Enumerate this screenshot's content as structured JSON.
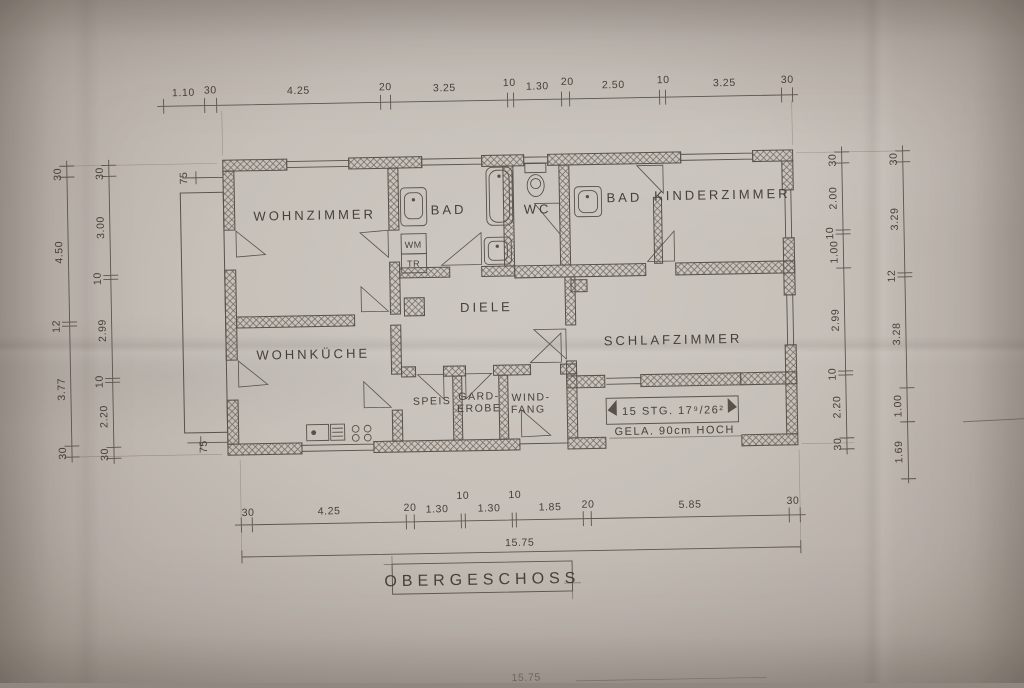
{
  "document": {
    "title": "OBERGESCHOSS",
    "type_note": "hand-drawn architectural floor plan photo"
  },
  "rooms": {
    "wohnzimmer": "WOHNZIMMER",
    "bad1": "BAD",
    "wc": "WC",
    "bad2": "BAD",
    "kinderzimmer": "KINDERZIMMER",
    "diele": "DIELE",
    "wohnkueche": "WOHNKÜCHE",
    "speis": "SPEIS",
    "garderobe_line1": "GARD-",
    "garderobe_line2": "EROBE",
    "windfang_line1": "WIND-",
    "windfang_line2": "FANG",
    "schlafzimmer": "SCHLAFZIMMER",
    "wm": "WM",
    "tr": "TR"
  },
  "stairs": {
    "label": "15 STG. 17⁹/26²",
    "railing_note": "GELA. 90cm HOCH"
  },
  "dims": {
    "top": [
      "1.10",
      "30",
      "4.25",
      "20",
      "3.25",
      "10",
      "1.30",
      "20",
      "2.50",
      "10",
      "3.25",
      "30"
    ],
    "bottom": [
      "30",
      "4.25",
      "20",
      "1.30",
      "10",
      "1.30",
      "10",
      "1.85",
      "20",
      "5.85",
      "30"
    ],
    "bottom_total": "15.75",
    "left_outer": [
      "30",
      "4.50",
      "12",
      "3.77",
      "30"
    ],
    "left_inner": [
      "30",
      "3.00",
      "10",
      "2.99",
      "10",
      "2.20",
      "30"
    ],
    "right_inner": [
      "30",
      "2.00",
      "10",
      "1.00",
      "2.99",
      "10",
      "2.20",
      "30"
    ],
    "right_outer": [
      "30",
      "3.29",
      "12",
      "3.28",
      "1.00",
      "1.69"
    ],
    "balcony_top": "75",
    "balcony_bottom": "75",
    "cropped_lower_total": "15.75"
  }
}
